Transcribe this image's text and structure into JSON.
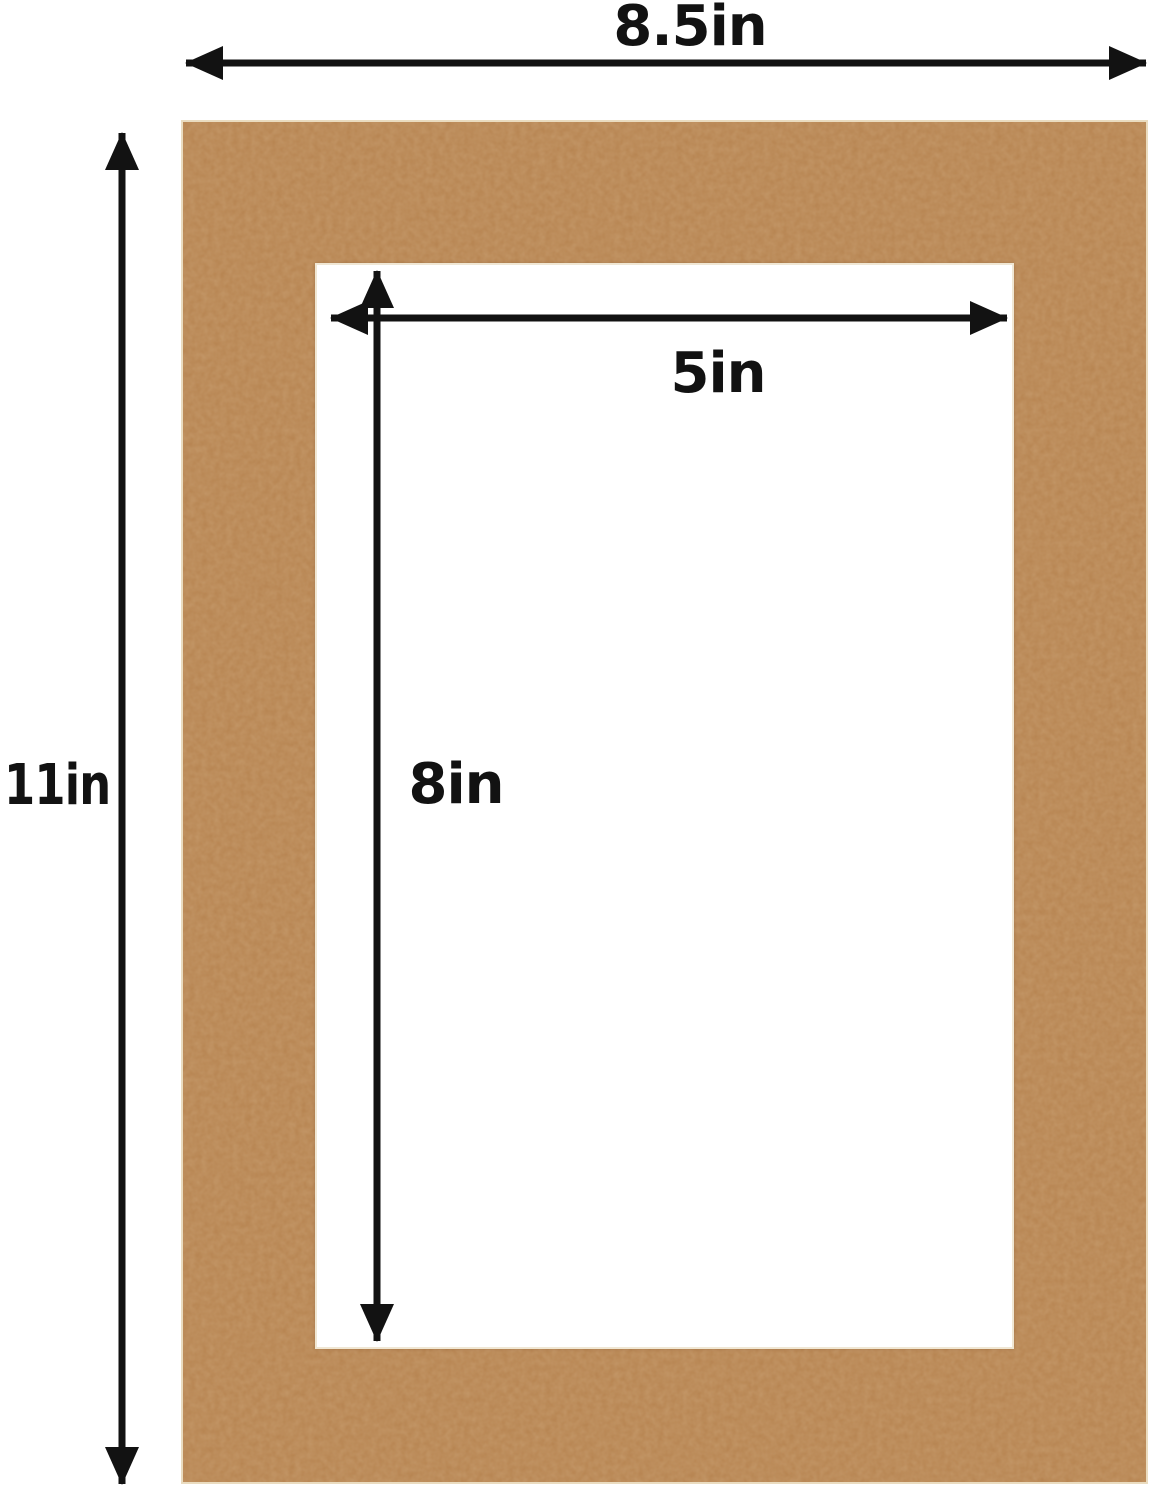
{
  "diagram": {
    "type": "picture-mat-dimension-diagram",
    "measurements": {
      "outer_width": {
        "label": "8.5in",
        "value": 8.5,
        "unit": "in",
        "orientation": "horizontal",
        "applies_to": "mat-outer-edge"
      },
      "outer_height": {
        "label": "11in",
        "value": 11,
        "unit": "in",
        "orientation": "vertical",
        "applies_to": "mat-outer-edge"
      },
      "opening_width": {
        "label": "5in",
        "value": 5,
        "unit": "in",
        "orientation": "horizontal",
        "applies_to": "mat-opening"
      },
      "opening_height": {
        "label": "8in",
        "value": 8,
        "unit": "in",
        "orientation": "vertical",
        "applies_to": "mat-opening"
      }
    }
  },
  "colors": {
    "background": "#ffffff",
    "mat": "#b7824e",
    "mat_edge": "#eadcc0",
    "bevel": "#f0e7d4",
    "opening": "#ffffff",
    "arrow": "#121212"
  }
}
